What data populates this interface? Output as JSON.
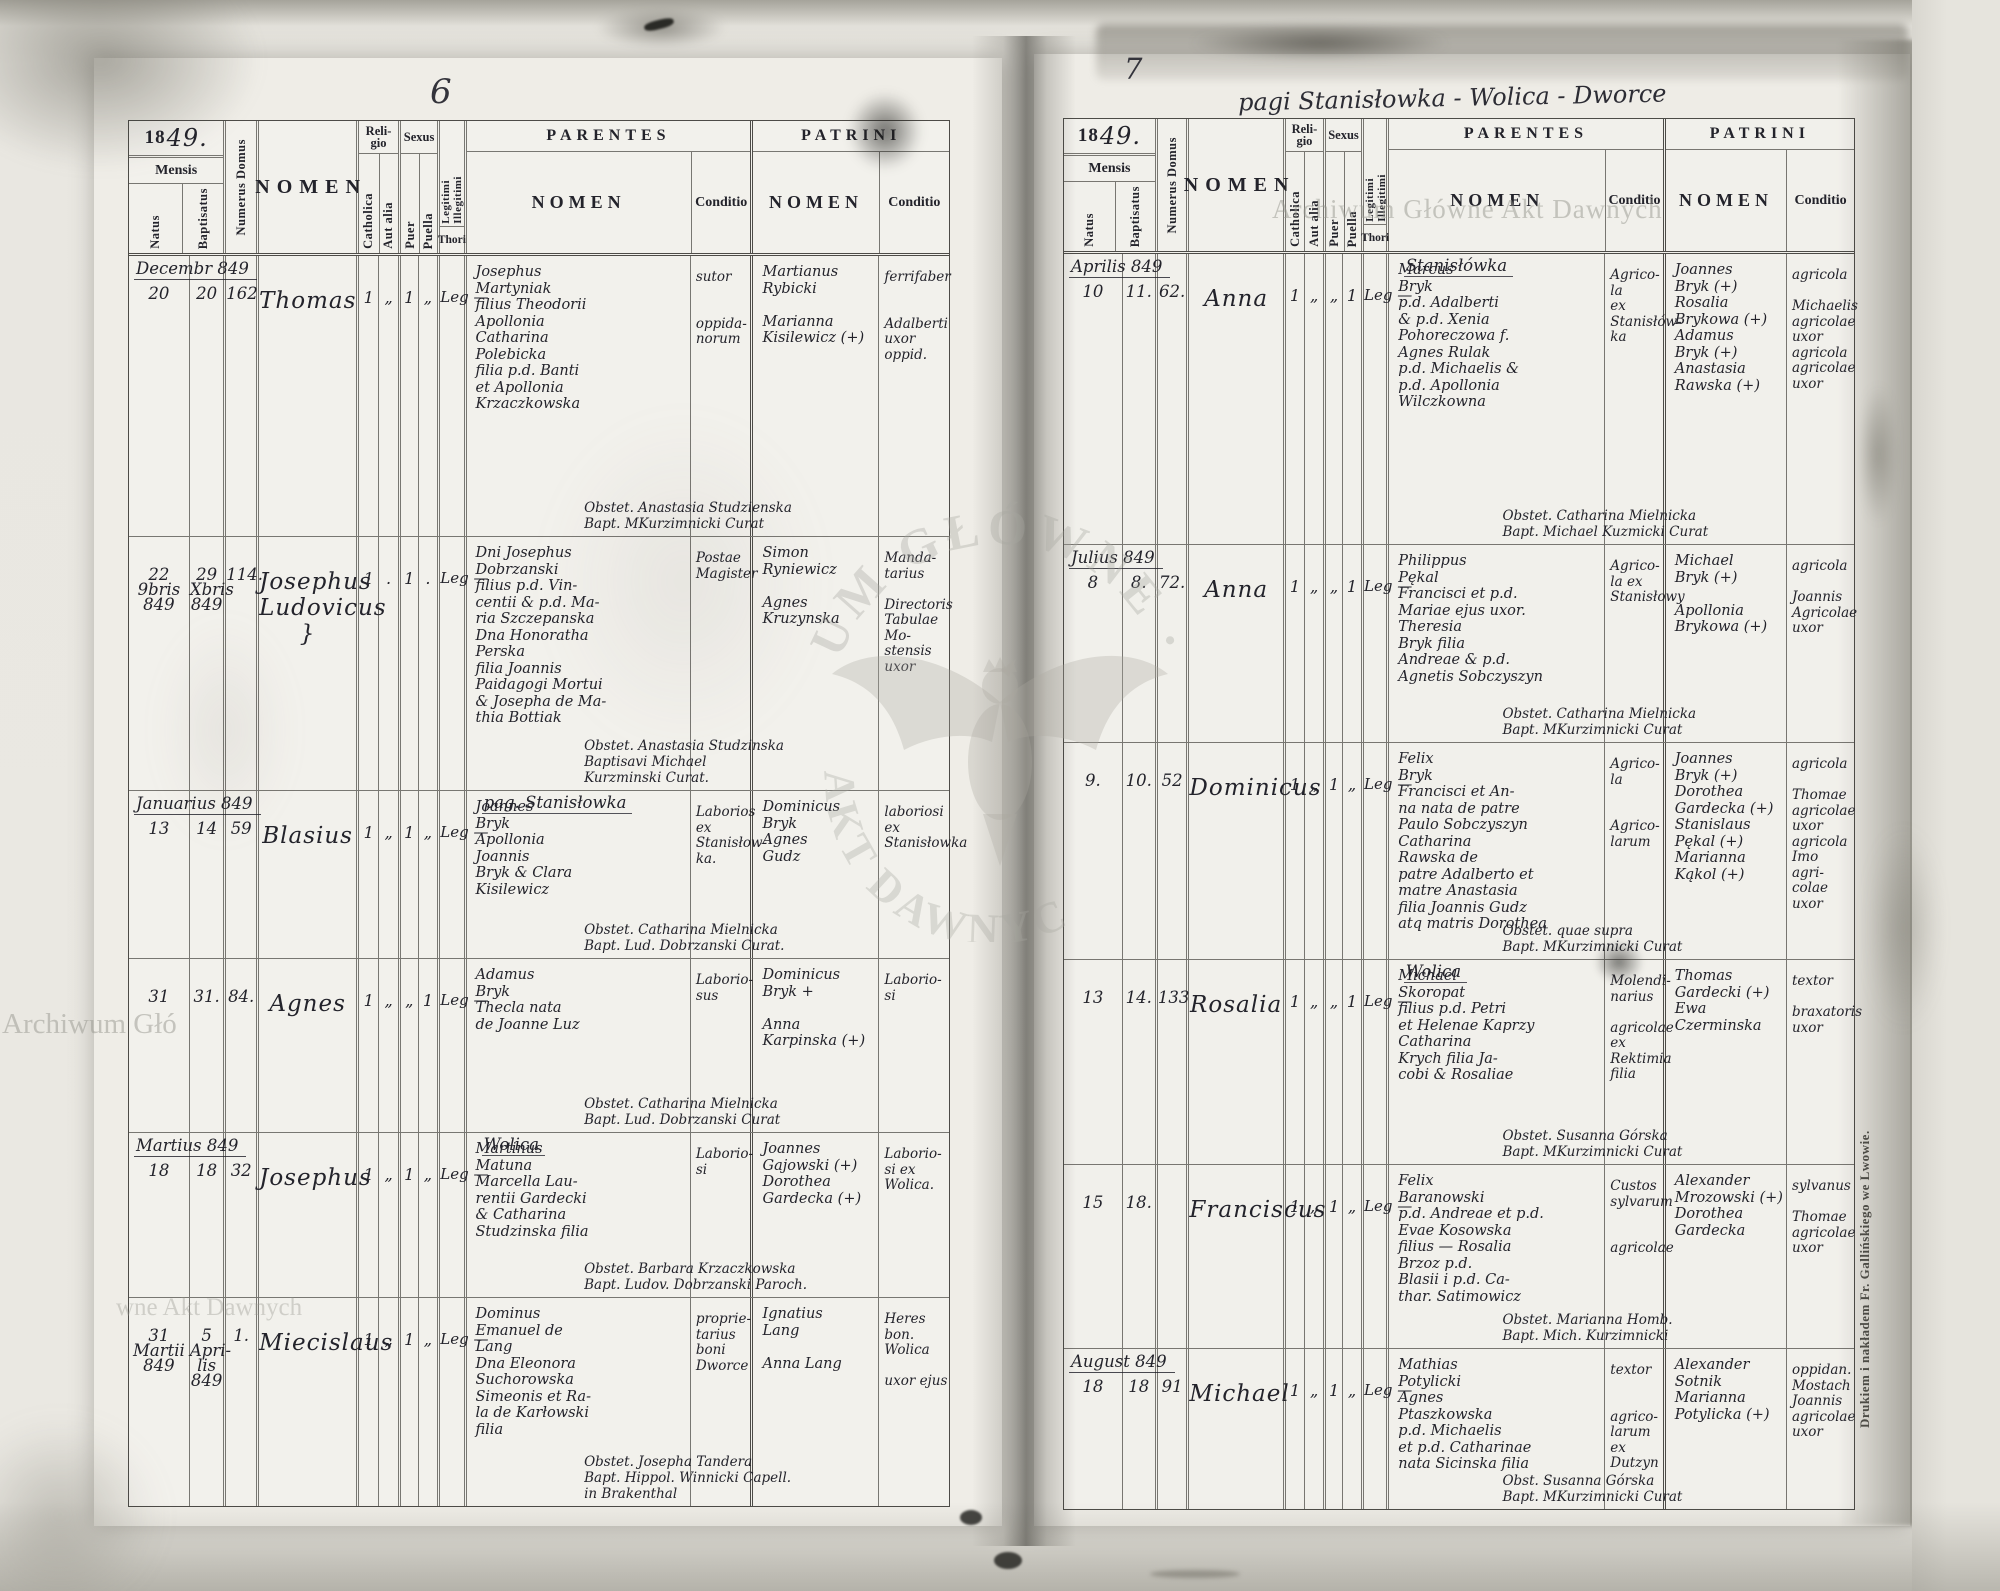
{
  "colors": {
    "paper": "#efede7",
    "ink": "#23232b",
    "table_line": "#3a3a33",
    "watermark_grey": "#96958e"
  },
  "annotations": {
    "left_page_number": "6",
    "right_page_number": "7",
    "heading": "pagi Stanisłowka - Wolica - Dworce",
    "imprint": "Drukiem i nakładem Fr. Gallińskiego we Lwowie."
  },
  "watermarks": {
    "archive_full": "Archiwum Główne Akt Dawnych",
    "archive_fragment_left": "Archiwum Głó",
    "archive_fragment_row": "wne Akt Dawnych",
    "eagle_arc_top": "UM GŁÓWNE ·",
    "eagle_arc_bottom": "AKT DAWNYCH"
  },
  "headers": {
    "year_printed": "18",
    "year_hand": "49.",
    "mensis": "Mensis",
    "natus": "Natus",
    "baptisatus": "Baptisatus",
    "numerus_domus": "Numerus Domus",
    "nomen": "NOMEN",
    "religio": "Reli-\ngio",
    "catholica": "Catholica",
    "aut_alia": "Aut alia",
    "sexus": "Sexus",
    "puer": "Puer",
    "puella": "Puella",
    "legitimi": "Legitimi",
    "illegitimi": "Illegitimi",
    "thori": "Thori",
    "parentes": "PARENTES",
    "patrini": "PATRINI",
    "nomen_sub": "NOMEN",
    "conditio": "Conditio"
  },
  "left": {
    "rows": [
      {
        "month": "Decembr 849",
        "place": "",
        "natus": "20",
        "baptisatus": "20",
        "domus": "162",
        "nomen": "Thomas",
        "catholica": "1",
        "aut_alia": "„",
        "puer": "1",
        "puella": "„",
        "leg": "Leg —",
        "parentes": "Josephus\nMartyniak\nfilius Theodorii\nApollonia\nCatharina\nPolebicka\nfilia p.d. Banti\net Apollonia\nKrzaczkowska",
        "parentes_conditio": "sutor\n\n\noppida-\nnorum",
        "patrini": "Martianus\nRybicki\n\nMarianna\nKisilewicz (+)",
        "patrini_conditio": "ferrifaber\n\n\nAdalberti\nuxor oppid.",
        "note": "Obstet. Anastasia Studzienska\nBapt. MKurzimnicki Curat"
      },
      {
        "month": "",
        "place": "",
        "natus": "22\n9bris\n849",
        "baptisatus": "29\nXbris\n849",
        "domus": "114.",
        "nomen": "Josephus\nLudovicus }",
        "catholica": "1",
        "aut_alia": ".",
        "puer": "1",
        "puella": ".",
        "leg": "Leg —",
        "parentes": "Dni Josephus\nDobrzanski\nfilius p.d. Vin-\ncentii & p.d. Ma-\nria Szczepanska\nDna Honoratha\nPerska\nfilia Joannis\nPaidagogi Mortui\n& Josepha de Ma-\nthia Bottiak",
        "parentes_conditio": "Postae\nMagister",
        "patrini": "Simon\nRyniewicz\n\nAgnes\nKruzynska",
        "patrini_conditio": "Manda-\ntarius\n\nDirectoris\nTabulae Mo-\nstensis uxor",
        "note": "Obstet. Anastasia Studzinska\nBaptisavi Michael\nKurzminski Curat."
      },
      {
        "month": "Januarius 849",
        "place": "pag. Stanisłowka",
        "natus": "13",
        "baptisatus": "14",
        "domus": "59",
        "nomen": "Blasius",
        "catholica": "1",
        "aut_alia": "„",
        "puer": "1",
        "puella": "„",
        "leg": "Leg —",
        "parentes": "Joannes\nBryk\nApollonia\nJoannis\nBryk & Clara\nKisilewicz",
        "parentes_conditio": "Laborios\nex\nStanisłow-\nka.",
        "patrini": "Dominicus\nBryk\nAgnes\nGudz",
        "patrini_conditio": "laboriosi\nex\nStanisłowka",
        "note": "Obstet. Catharina Mielnicka\nBapt. Lud. Dobrzanski Curat."
      },
      {
        "month": "",
        "place": "",
        "natus": "31",
        "baptisatus": "31.",
        "domus": "84.",
        "nomen": "Agnes",
        "catholica": "1",
        "aut_alia": "„",
        "puer": "„",
        "puella": "1",
        "leg": "Leg —",
        "parentes": "Adamus\nBryk\nThecla nata\nde Joanne Luz",
        "parentes_conditio": "Laborio-\nsus",
        "patrini": "Dominicus\nBryk +\n\nAnna\nKarpinska (+)",
        "patrini_conditio": "Laborio-\nsi",
        "note": "Obstet. Catharina Mielnicka\nBapt. Lud. Dobrzanski Curat"
      },
      {
        "month": "Martius 849",
        "place": "Wolica",
        "natus": "18",
        "baptisatus": "18",
        "domus": "32",
        "nomen": "Josephus",
        "catholica": "1",
        "aut_alia": "„",
        "puer": "1",
        "puella": "„",
        "leg": "Leg —",
        "parentes": "Martinus\nMatuna\nMarcella Lau-\nrentii Gardecki\n& Catharina\nStudzinska filia",
        "parentes_conditio": "Laborio-\nsi",
        "patrini": "Joannes\nGajowski (+)\nDorothea\nGardecka (+)",
        "patrini_conditio": "Laborio-\nsi ex\nWolica.",
        "note": "Obstet. Barbara Krzaczkowska\nBapt. Ludov. Dobrzanski Paroch."
      },
      {
        "month": "",
        "place": "",
        "natus": "31\nMartii\n849",
        "baptisatus": "5\nApri-\nlis 849",
        "domus": "1.",
        "nomen": "Miecislaus",
        "catholica": "1",
        "aut_alia": "„",
        "puer": "1",
        "puella": "„",
        "leg": "Leg —",
        "parentes": "Dominus\nEmanuel de\nLang\nDna Eleonora\nSuchorowska\nSimeonis et Ra-\nla de Karłowski\nfilia",
        "parentes_conditio": "proprie-\ntarius\nboni\nDworce",
        "patrini": "Ignatius\nLang\n\nAnna Lang",
        "patrini_conditio": "Heres\nbon. Wolica\n\nuxor ejus",
        "note": "Obstet. Josepha Tandera\nBapt. Hippol. Winnicki Capell.\nin Brakenthal"
      }
    ]
  },
  "right": {
    "rows": [
      {
        "month": "Aprilis 849",
        "place": "Stanisłówka",
        "natus": "10",
        "baptisatus": "11.",
        "domus": "62.",
        "nomen": "Anna",
        "catholica": "1",
        "aut_alia": "„",
        "puer": "„",
        "puella": "1",
        "leg": "Leg —",
        "parentes": "Marcus\nBryk\np.d. Adalberti\n& p.d. Xenia\nPohoreczowa f.\nAgnes Rulak\np.d. Michaelis &\np.d. Apollonia\nWilczkowna",
        "parentes_conditio": "Agrico-\nla\nex\nStanisłów-\nka",
        "patrini": "Joannes\nBryk (+)\nRosalia\nBrykowa (+)\nAdamus\nBryk (+)\nAnastasia\nRawska (+)",
        "patrini_conditio": "agricola\n\nMichaelis\nagricolae\nuxor\nagricola\nagricolae\nuxor",
        "note": "Obstet. Catharina Mielnicka\nBapt. Michael Kuzmicki Curat"
      },
      {
        "month": "Julius 849",
        "place": "",
        "natus": "8",
        "baptisatus": "8.",
        "domus": "72.",
        "nomen": "Anna",
        "catholica": "1",
        "aut_alia": "„",
        "puer": "„",
        "puella": "1",
        "leg": "Leg —",
        "parentes": "Philippus\nPękal\nFrancisci et p.d.\nMariae ejus uxor.\nTheresia\nBryk filia\nAndreae & p.d.\nAgnetis Sobczyszyn",
        "parentes_conditio": "Agrico-\nla ex\nStanisłowy",
        "patrini": "Michael\nBryk (+)\n\nApollonia\nBrykowa (+)",
        "patrini_conditio": "agricola\n\nJoannis\nAgricolae\nuxor",
        "note": "Obstet. Catharina Mielnicka\nBapt. MKurzimnicki Curat"
      },
      {
        "month": "",
        "place": "",
        "natus": "9.",
        "baptisatus": "10.",
        "domus": "52",
        "nomen": "Dominicus",
        "catholica": "1",
        "aut_alia": "„",
        "puer": "1",
        "puella": "„",
        "leg": "Leg —",
        "parentes": "Felix\nBryk\nFrancisci et An-\nna nata de patre\nPaulo Sobczyszyn\nCatharina\nRawska de\npatre Adalberto et\nmatre Anastasia\nfilia Joannis Gudz\natq matris Dorothea",
        "parentes_conditio": "Agrico-\nla\n\n\nAgrico-\nlarum",
        "patrini": "Joannes\nBryk (+)\nDorothea\nGardecka (+)\nStanislaus\nPękal (+)\nMarianna\nKąkol (+)",
        "patrini_conditio": "agricola\n\nThomae\nagricolae\nuxor\nagricola\nImo agri-\ncolae uxor",
        "note": "Obstet. quae supra\nBapt. MKurzimnicki Curat"
      },
      {
        "month": "",
        "place": "Wolica",
        "natus": "13",
        "baptisatus": "14.",
        "domus": "133",
        "nomen": "Rosalia",
        "catholica": "1",
        "aut_alia": "„",
        "puer": "„",
        "puella": "1",
        "leg": "Leg —",
        "parentes": "Michael\nSkoropat\nfilius p.d. Petri\net Helenae Kaprzy\nCatharina\nKrych filia Ja-\ncobi & Rosaliae",
        "parentes_conditio": "Molendi-\nnarius\n\nagricolae\nex\nRektimia\nfilia",
        "patrini": "Thomas\nGardecki (+)\nEwa\nCzerminska",
        "patrini_conditio": "textor\n\nbraxatoris\nuxor",
        "note": "Obstet. Susanna Górska\nBapt. MKurzimnicki Curat"
      },
      {
        "month": "",
        "place": "",
        "natus": "15",
        "baptisatus": "18.",
        "domus": "",
        "nomen": "Franciscus",
        "catholica": "1",
        "aut_alia": "„",
        "puer": "1",
        "puella": "„",
        "leg": "Leg —",
        "parentes": "Felix\nBaranowski\np.d. Andreae et p.d.\nEvae Kosowska\nfilius — Rosalia\nBrzoz p.d.\nBlasii i p.d. Ca-\nthar. Satimowicz",
        "parentes_conditio": "Custos\nsylvarum\n\n\nagricolae",
        "patrini": "Alexander\nMrozowski (+)\nDorothea\nGardecka",
        "patrini_conditio": "sylvanus\n\nThomae\nagricolae\nuxor",
        "note": "Obstet. Marianna Homb.\nBapt. Mich. Kurzimnicki"
      },
      {
        "month": "August 849",
        "place": "",
        "natus": "18",
        "baptisatus": "18",
        "domus": "91",
        "nomen": "Michael",
        "catholica": "1",
        "aut_alia": "„",
        "puer": "1",
        "puella": "„",
        "leg": "Leg —",
        "parentes": "Mathias\nPotylicki\nAgnes\nPtaszkowska\np.d. Michaelis\net p.d. Catharinae\nnata Sicinska filia",
        "parentes_conditio": "textor\n\n\nagrico-\nlarum\nex\nDutzyn",
        "patrini": "Alexander\nSotnik\nMarianna\nPotylicka (+)",
        "patrini_conditio": "oppidan.\nMostach\nJoannis\nagricolae\nuxor",
        "note": "Obst. Susanna Górska\nBapt. MKurzimnicki Curat"
      }
    ]
  }
}
